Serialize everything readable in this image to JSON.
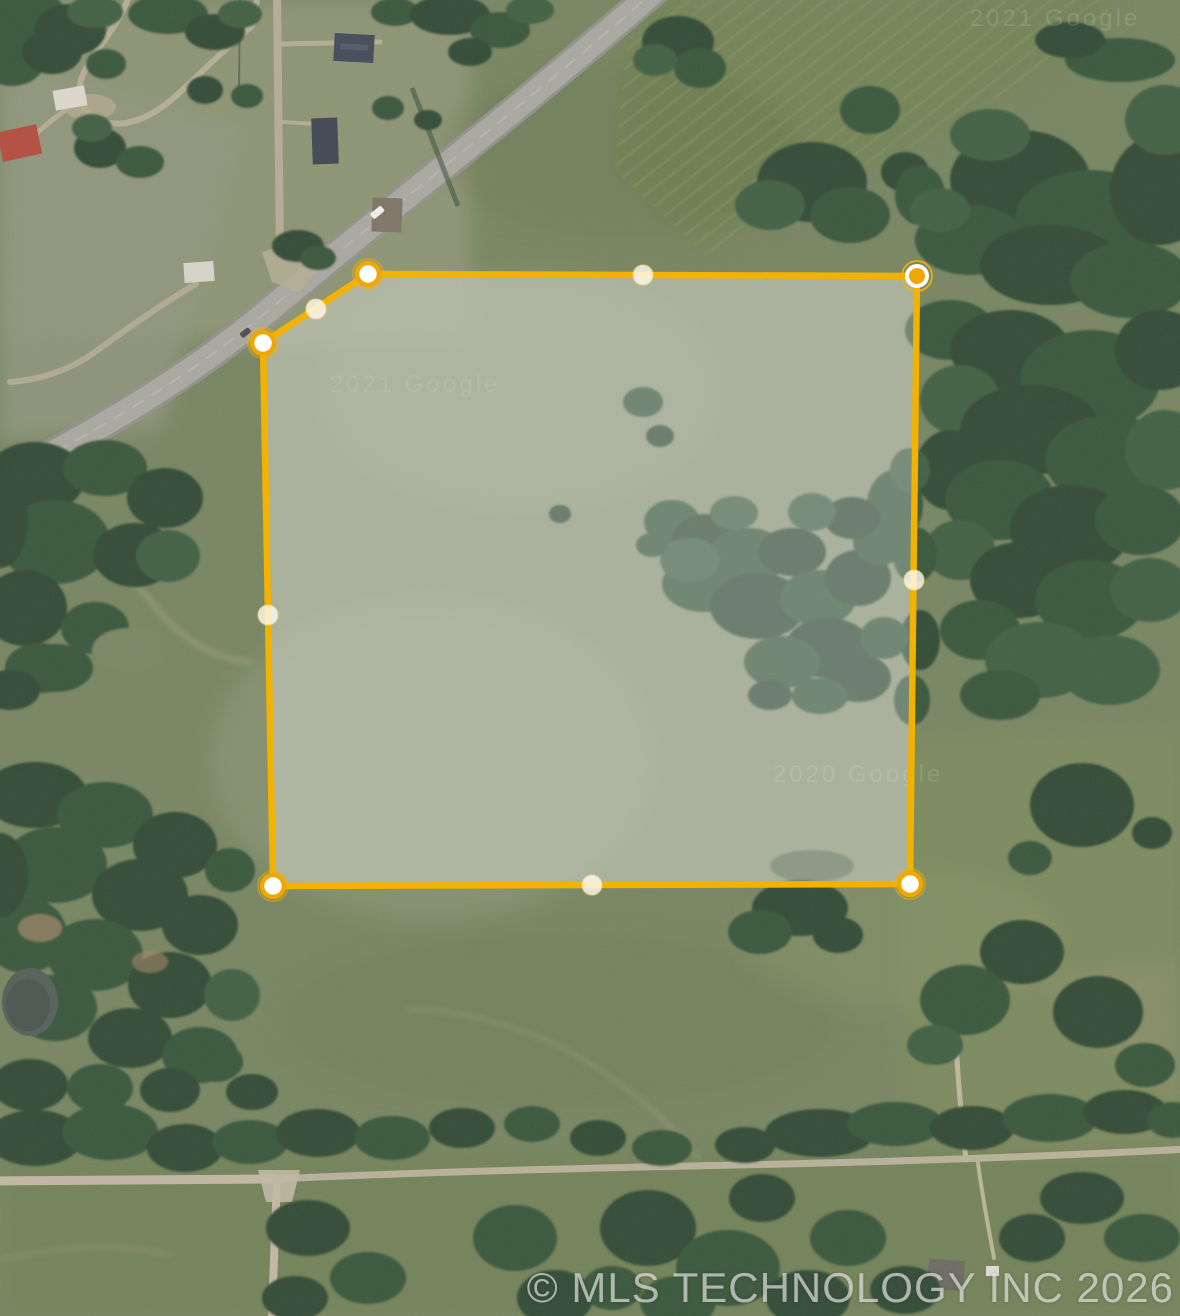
{
  "map": {
    "view": "satellite",
    "attribution": "© MLS TECHNOLOGY INC 2026",
    "imagery_watermarks": [
      {
        "text": "2021 Google",
        "x": 1055,
        "y": 26,
        "opacity": 0.13
      },
      {
        "text": "2021 Google",
        "x": 415,
        "y": 392,
        "opacity": 0.09
      },
      {
        "text": "2020 Google",
        "x": 858,
        "y": 782,
        "opacity": 0.11
      }
    ],
    "parcel": {
      "stroke_color": "#F3B100",
      "stroke_width": 6.5,
      "fill_color": "rgba(255,255,255,0.27)",
      "underlay_color": "rgba(150,158,135,0.5)",
      "vertices": [
        {
          "x": 368,
          "y": 274,
          "state": "default"
        },
        {
          "x": 917,
          "y": 276,
          "state": "selected"
        },
        {
          "x": 910,
          "y": 884,
          "state": "default"
        },
        {
          "x": 273,
          "y": 886,
          "state": "default"
        },
        {
          "x": 263,
          "y": 343,
          "state": "default"
        }
      ],
      "midpoints": [
        {
          "x": 643,
          "y": 275
        },
        {
          "x": 914,
          "y": 580
        },
        {
          "x": 592,
          "y": 885
        },
        {
          "x": 268,
          "y": 615
        },
        {
          "x": 316,
          "y": 309
        }
      ],
      "vertex_style": {
        "radius": 11,
        "fill": "#FFFFFF",
        "ring_color": "#F1A600",
        "ring_width": 4.5,
        "glow": "rgba(244,180,0,0.45)"
      },
      "selected_vertex_style": {
        "radius": 10,
        "fill": "#EFA606",
        "ring_color": "#FFFFFF",
        "ring_width": 4,
        "glow": "rgba(244,180,0,0.85)"
      },
      "midpoint_style": {
        "radius": 10,
        "fill": "rgba(255,252,242,0.8)",
        "ring_color": "rgba(250,215,130,0.5)",
        "ring_width": 1.5
      }
    }
  }
}
